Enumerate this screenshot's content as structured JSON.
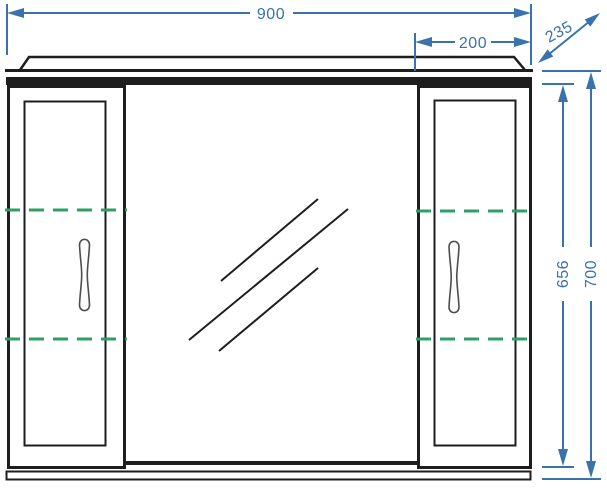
{
  "drawing": {
    "kind": "furniture-front-elevation-technical-drawing",
    "labels": {
      "total_width": "900",
      "right_section_width": "200",
      "depth": "235",
      "inner_height": "656",
      "total_height": "700"
    },
    "colors": {
      "dimension_blue": "#3a72ad",
      "shelf_green": "#2f9e68",
      "line_dark": "#1e1e1e",
      "background": "#ffffff"
    }
  }
}
